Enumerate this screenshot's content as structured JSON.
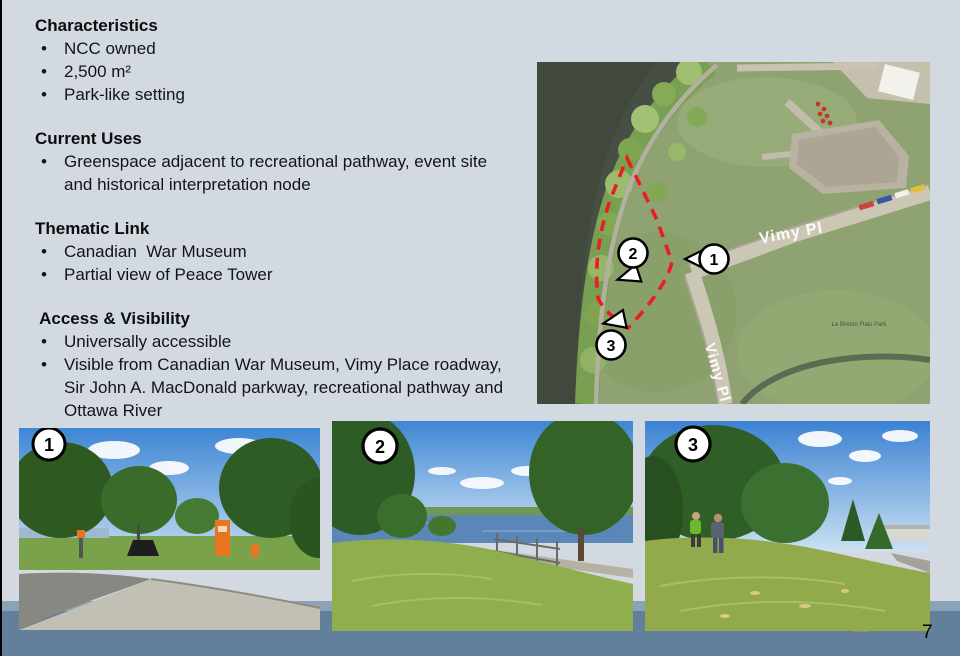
{
  "content": {
    "sections": [
      {
        "title": "Characteristics",
        "bullets": [
          "NCC owned",
          "2,500 m²",
          "Park-like setting"
        ]
      },
      {
        "title": "Current Uses",
        "bullets": [
          "Greenspace adjacent to recreational pathway, event site and historical interpretation node"
        ]
      },
      {
        "title": "Thematic Link",
        "bullets": [
          "Canadian  War Museum",
          "Partial view of Peace Tower"
        ]
      },
      {
        "title": " Access & Visibility",
        "bullets": [
          "Universally accessible",
          "Visible from Canadian War Museum, Vimy Place roadway, Sir John A. MacDonald parkway, recreational pathway and Ottawa River"
        ]
      }
    ]
  },
  "map": {
    "road_label_upper": "Vimy Pl",
    "road_label_lower": "Vimy Pl",
    "park_label": "Le Breton Flats Park",
    "markers": [
      "1",
      "2",
      "3"
    ],
    "boundary_color": "#ec1c24"
  },
  "photos": [
    {
      "badge": "1"
    },
    {
      "badge": "2"
    },
    {
      "badge": "3"
    }
  ],
  "footer": {
    "inner_page_number": "12",
    "slide_number": "7"
  }
}
